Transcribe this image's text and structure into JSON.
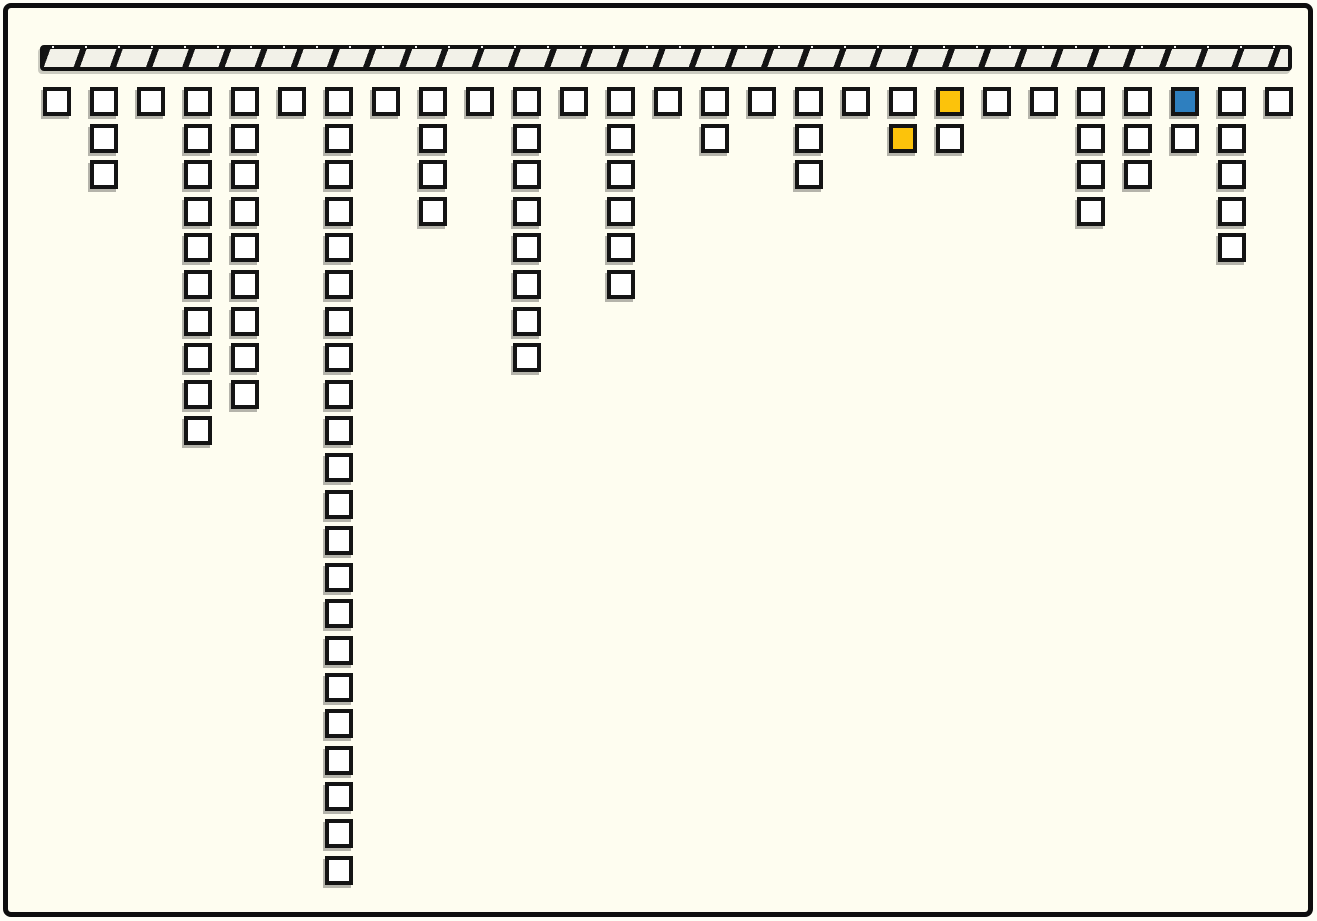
{
  "canvas": {
    "width": 1317,
    "height": 921,
    "background_color": "#FEFDF0",
    "frame_color": "#0E0E0E"
  },
  "ceiling_bar": {
    "x": 32,
    "y": 37,
    "width": 1244,
    "height": 18,
    "hatch_segment_spacing": 34,
    "hatch_stripe_color": "#141414",
    "hatch_fill_color": "#F2F1E8",
    "top_dot_color": "#FFFFFF"
  },
  "grid": {
    "origin_x": 35,
    "origin_y": 79,
    "col_pitch": 47,
    "row_pitch": 36.6,
    "square_width": 28,
    "square_height": 29,
    "square_border_color": "#141414",
    "square_fill_color": "#FFFFFF",
    "num_columns": 27,
    "columns_square_counts": [
      1,
      3,
      1,
      10,
      9,
      1,
      22,
      1,
      4,
      1,
      8,
      1,
      6,
      1,
      2,
      1,
      3,
      1,
      2,
      2,
      1,
      1,
      4,
      3,
      2,
      5,
      1
    ],
    "total_squares": 97,
    "highlight_cells": [
      {
        "col": 20,
        "row": 1,
        "color_name": "yellow"
      },
      {
        "col": 19,
        "row": 2,
        "color_name": "yellow"
      },
      {
        "col": 25,
        "row": 1,
        "color_name": "blue"
      }
    ],
    "highlight_colors": {
      "yellow": "#FCC30B",
      "blue": "#2E7FBF"
    }
  }
}
